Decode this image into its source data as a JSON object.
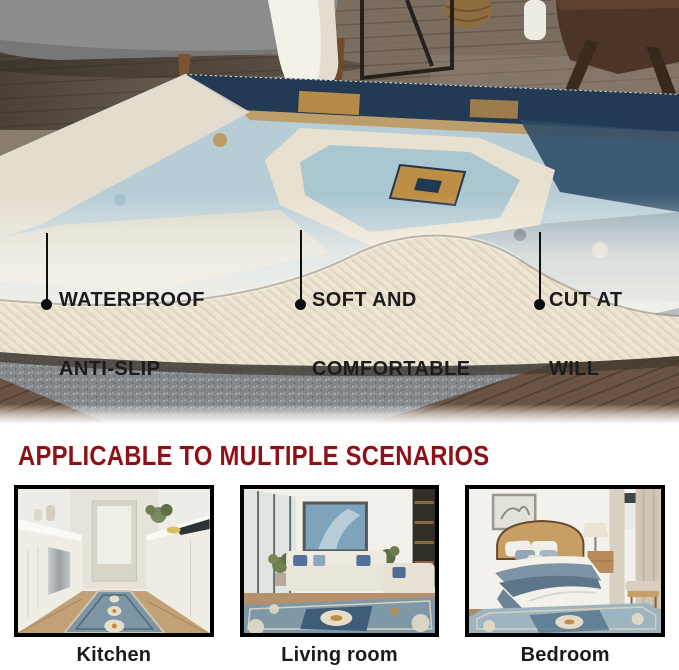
{
  "photo": {
    "callouts": [
      {
        "line1": "WATERPROOF",
        "line2": "ANTI-SLIP"
      },
      {
        "line1": "SOFT AND",
        "line2": "COMFORTABLE"
      },
      {
        "line1": "CUT AT",
        "line2": "WILL"
      }
    ]
  },
  "section": {
    "heading": "APPLICABLE TO MULTIPLE SCENARIOS",
    "scenarios": [
      {
        "label": "Kitchen"
      },
      {
        "label": "Living room"
      },
      {
        "label": "Bedroom"
      }
    ]
  },
  "colors": {
    "heading_red": "#8e1118",
    "callout_text": "#1c1c1c",
    "callout_marker": "#0d0d0d",
    "thumbnail_border": "#000000",
    "label_text": "#1b1b1b",
    "background": "#ffffff"
  }
}
